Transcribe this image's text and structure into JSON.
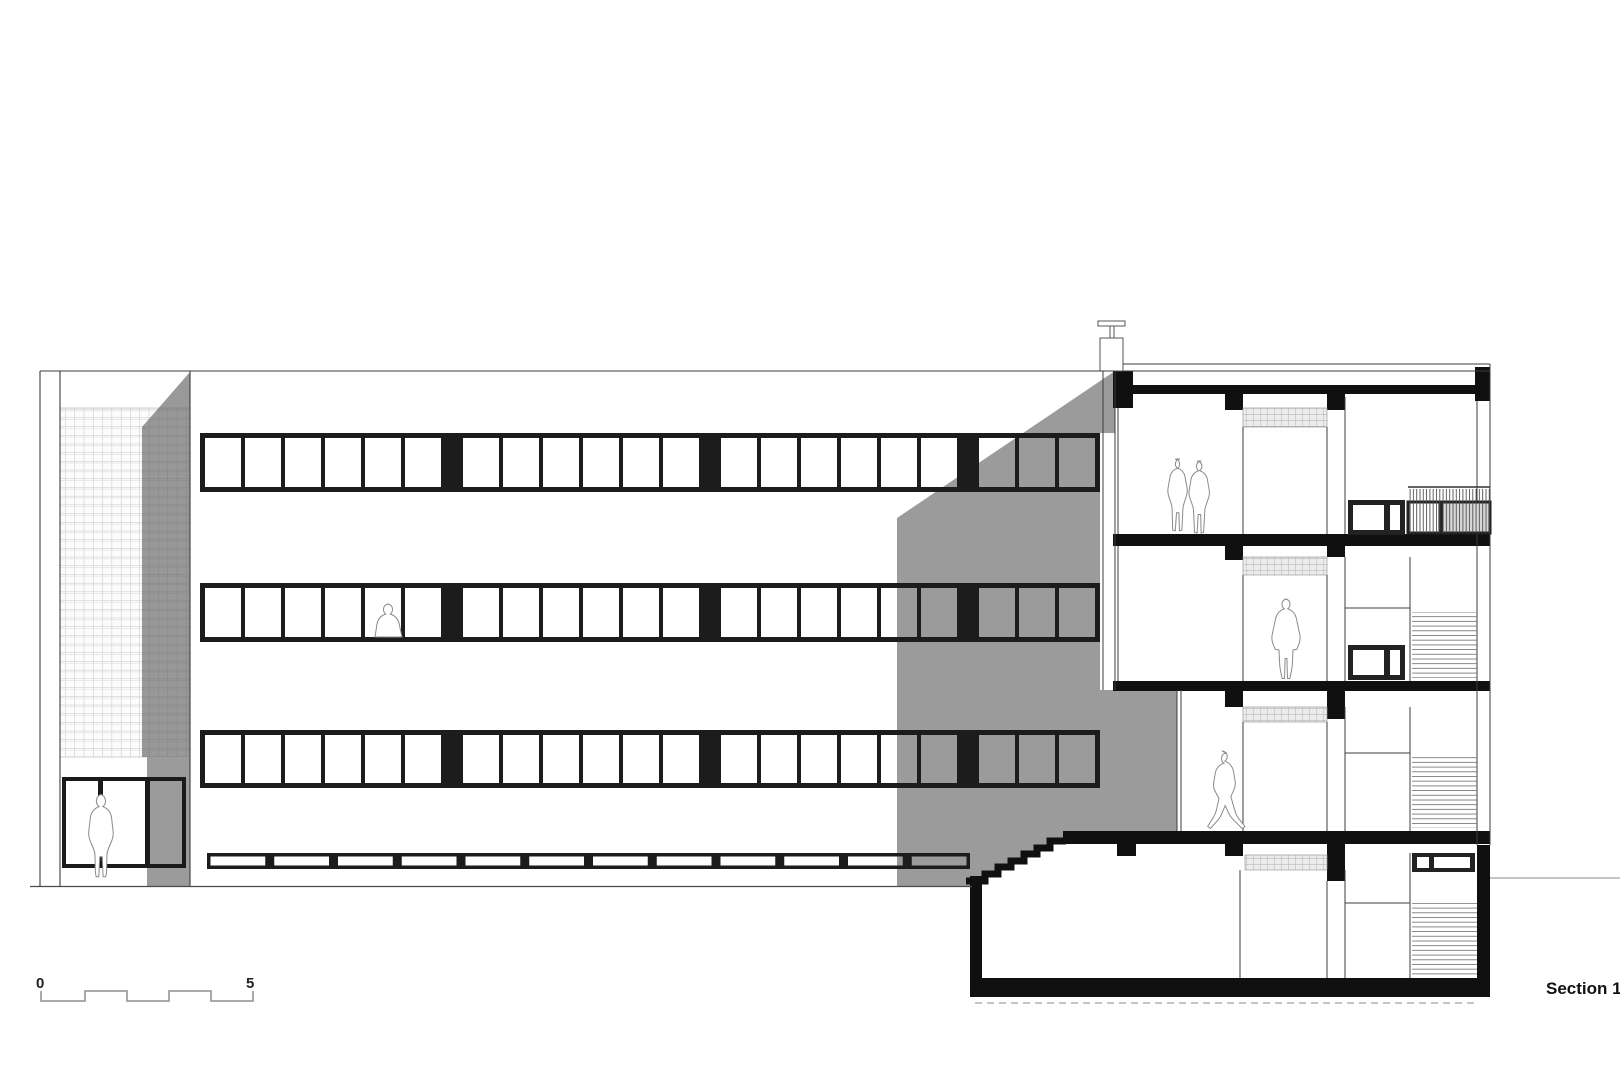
{
  "title": {
    "label": "Section 1-1"
  },
  "scale_bar": {
    "start_label": "0",
    "end_label": "5"
  },
  "drawing": {
    "shadow_color": "#9b9b9b",
    "ink_color": "#1c1c1c",
    "window_bands": {
      "x": 200,
      "width": 900,
      "frame": 5,
      "pane_width": 36,
      "mullion": 4,
      "spacer": 22,
      "groups": [
        6,
        6,
        6,
        3
      ],
      "rows": [
        {
          "y": 433,
          "h": 59
        },
        {
          "y": 583,
          "h": 59
        },
        {
          "y": 730,
          "h": 58
        }
      ]
    },
    "plinth_band": {
      "x": 207,
      "y": 853,
      "width": 763,
      "h": 16,
      "frame": 3.5,
      "panes": 12,
      "post": 9
    },
    "entrance_door": {
      "x": 62,
      "y": 777,
      "width": 124,
      "h": 91
    },
    "floors": {
      "roof_slab_y": 385,
      "third_floor_slab_y": 534,
      "second_floor_slab_y": 681,
      "ground_slab_y": 831,
      "basement_slab_y": 978
    },
    "figures": [
      "person-at-entrance",
      "person-at-window",
      "couple-top-floor",
      "person-second-floor",
      "person-walking-ground-floor"
    ]
  }
}
